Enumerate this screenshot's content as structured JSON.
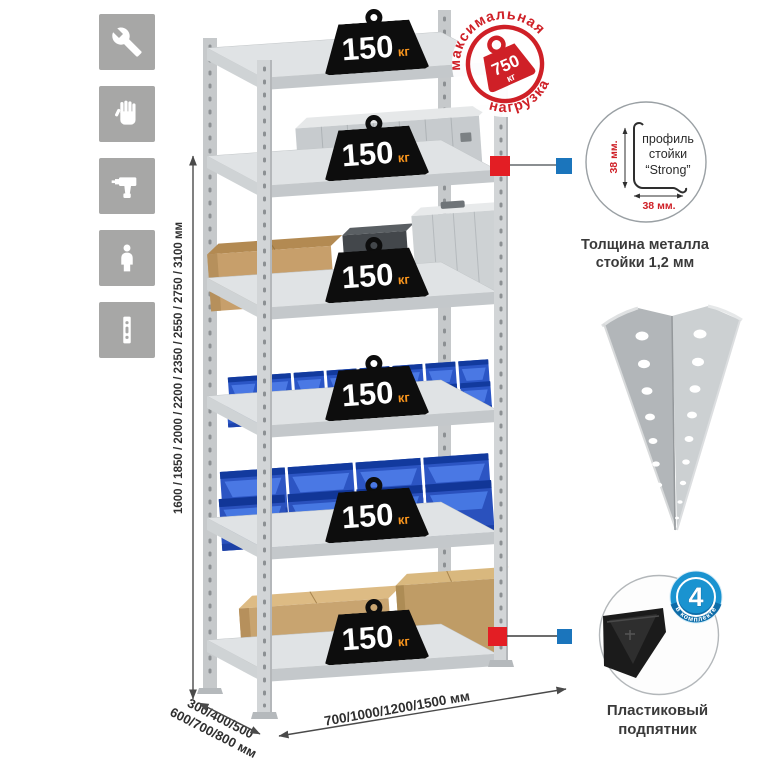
{
  "left_icons": [
    {
      "name": "wrench-icon"
    },
    {
      "name": "gloves-icon"
    },
    {
      "name": "drill-icon"
    },
    {
      "name": "person-icon"
    },
    {
      "name": "rack-post-icon"
    }
  ],
  "dimensions": {
    "height": "1600 / 1850 / 2000 / 2200 / 2350 / 2550 / 2750 / 3100 мм",
    "depth_line1": "300/400/500",
    "depth_line2": "600/700/800 мм",
    "width": "700/1000/1200/1500 мм"
  },
  "max_load_stamp": {
    "arc_top": "максимальная",
    "arc_bottom": "нагрузка",
    "value": "750",
    "unit": "кг"
  },
  "rack": {
    "weights": [
      {
        "value": "150",
        "unit": "кг"
      },
      {
        "value": "150",
        "unit": "кг"
      },
      {
        "value": "150",
        "unit": "кг"
      },
      {
        "value": "150",
        "unit": "кг"
      },
      {
        "value": "150",
        "unit": "кг"
      },
      {
        "value": "150",
        "unit": "кг"
      }
    ]
  },
  "profile_detail": {
    "text_line1": "профиль",
    "text_line2": "стойки",
    "text_line3": "“Strong”",
    "dim_vertical": "38 мм.",
    "dim_horizontal": "38 мм.",
    "caption_line1": "Толщина металла",
    "caption_line2": "стойки 1,2 мм"
  },
  "foot_detail": {
    "badge_value": "4",
    "badge_arc": "в комплекте",
    "caption_line1": "Пластиковый",
    "caption_line2": "подпятник"
  },
  "colors": {
    "icon_tile_bg": "#a7a7a6",
    "stamp_red": "#cf2027",
    "marker_red": "#e31e24",
    "marker_blue": "#1b75bc",
    "badge_blue": "#1a93d0",
    "bin_blue": "#2b56c6",
    "kg_orange": "#f7941d",
    "weight_black": "#0d0d0d"
  }
}
